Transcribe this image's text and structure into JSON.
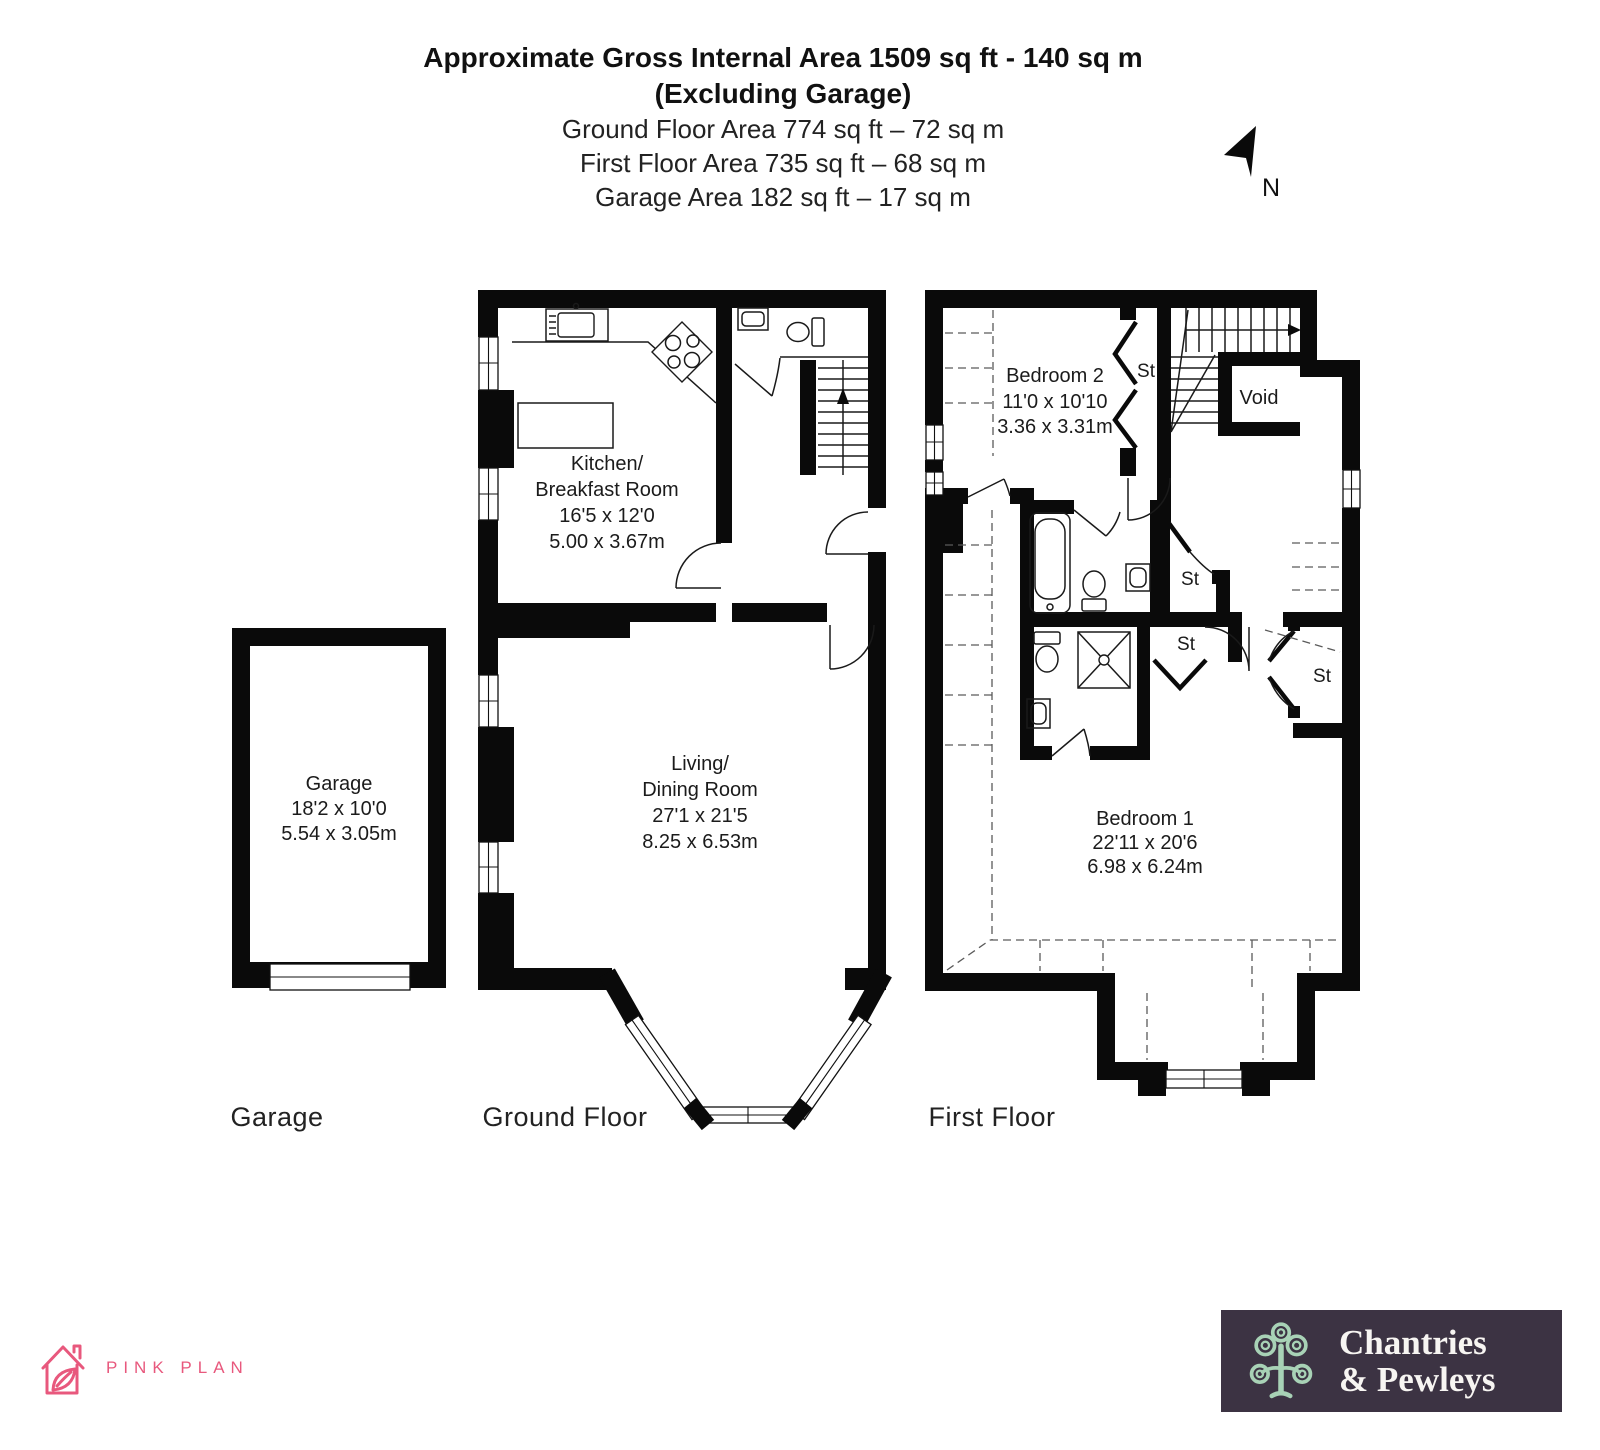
{
  "header": {
    "line1": "Approximate Gross Internal Area 1509 sq ft - 140 sq m",
    "line2": "(Excluding Garage)",
    "line3": "Ground Floor Area 774 sq ft – 72 sq m",
    "line4": "First Floor Area 735 sq ft – 68 sq m",
    "line5": "Garage Area 182 sq ft – 17 sq m"
  },
  "compass": {
    "north_label": "N"
  },
  "plans": {
    "garage": {
      "caption": "Garage",
      "room": {
        "name": "Garage",
        "imperial": "18'2 x 10'0",
        "metric": "5.54 x 3.05m"
      }
    },
    "ground_floor": {
      "caption": "Ground Floor",
      "kitchen": {
        "name_line1": "Kitchen/",
        "name_line2": "Breakfast Room",
        "imperial": "16'5 x 12'0",
        "metric": "5.00 x 3.67m"
      },
      "living": {
        "name_line1": "Living/",
        "name_line2": "Dining Room",
        "imperial": "27'1 x 21'5",
        "metric": "8.25 x 6.53m"
      }
    },
    "first_floor": {
      "caption": "First Floor",
      "bedroom2": {
        "name": "Bedroom 2",
        "imperial": "11'0 x 10'10",
        "metric": "3.36 x 3.31m"
      },
      "bedroom1": {
        "name": "Bedroom 1",
        "imperial": "22'11 x 20'6",
        "metric": "6.98 x 6.24m"
      },
      "void_label": "Void",
      "st_labels": [
        "St",
        "St",
        "St",
        "St"
      ]
    }
  },
  "footer": {
    "pink_plan": {
      "brand": "PINK PLAN",
      "color": "#e8587d"
    },
    "agency": {
      "name_line1": "Chantries",
      "name_line2": "& Pewleys",
      "bg_color": "#3c3343",
      "tree_color": "#a8d2b6",
      "text_color": "#f7f5f2"
    }
  },
  "colors": {
    "wall": "#0a0a0a",
    "fixture_line": "#1a1a1a",
    "dashed_line": "#5a5a5a"
  }
}
